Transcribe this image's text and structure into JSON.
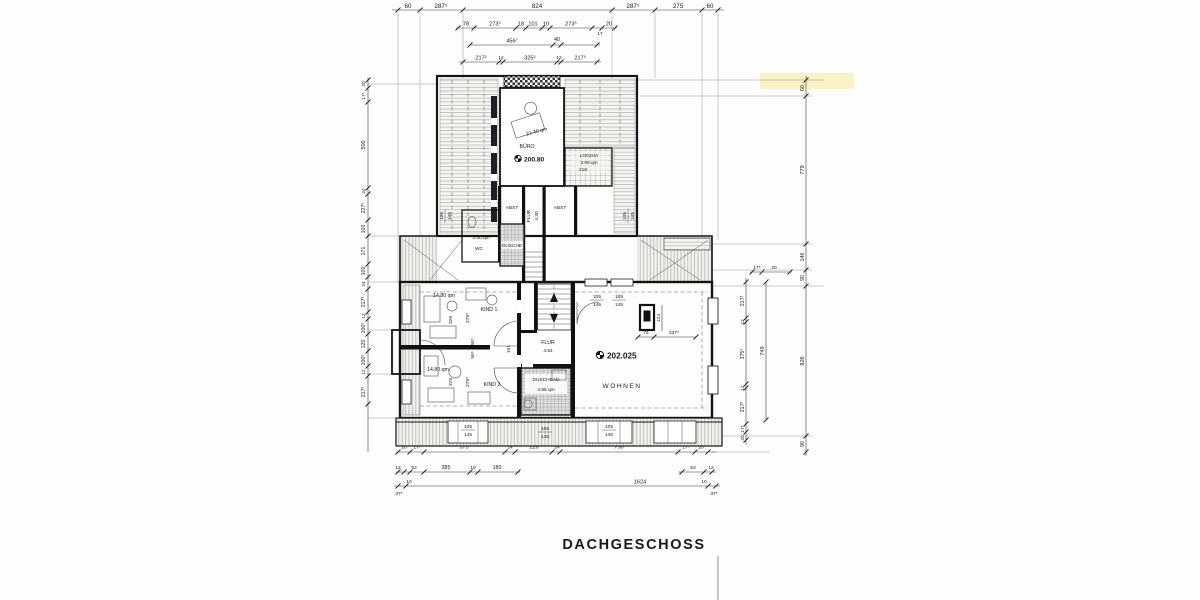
{
  "title": "DACHGESCHOSS",
  "levels": {
    "upper": "200.80",
    "lower": "202.025"
  },
  "rooms": {
    "buero": {
      "label": "BÜRO",
      "area": "21.40 qm"
    },
    "loggia": {
      "label": "LOGGIA",
      "area": "3.69 qm",
      "width": "218"
    },
    "abst_left": {
      "label": "ABST"
    },
    "abst_right": {
      "label": "ABST"
    },
    "flur_upper": {
      "label": "FLUR",
      "area": "4.30"
    },
    "wc": {
      "label": "WC",
      "area": "3.50 qm"
    },
    "dusche": {
      "label": "DUSCHE"
    },
    "kind1": {
      "label": "KIND 1",
      "area": "14.80 qm"
    },
    "kind2": {
      "label": "KIND 2",
      "area": "14.80 qm"
    },
    "flur": {
      "label": "FLUR",
      "area": "4.54"
    },
    "duschbad": {
      "label": "DUSCHBAD",
      "area": "4.85 qm"
    },
    "wohnen": {
      "label": "WOHNEN"
    }
  },
  "dims": {
    "top1": [
      "60",
      "287⁵",
      "824",
      "287⁵",
      "275",
      "60"
    ],
    "top2": [
      "78",
      "273⁵",
      "18",
      "101",
      "10",
      "273⁵",
      "17",
      "20"
    ],
    "top3": [
      "456⁷",
      "40"
    ],
    "top4": [
      "217²",
      "12",
      "325⁵",
      "12",
      "217³"
    ],
    "left": [
      "20",
      "17⁵",
      "500",
      "24",
      "227⁵",
      "100",
      "171",
      "100",
      "24",
      "217³",
      "12",
      "100⁵",
      "120",
      "100⁵",
      "12",
      "217²"
    ],
    "right_outer": [
      "60",
      "779",
      "146",
      "90",
      "826",
      "90"
    ],
    "right_corner": [
      "17⁵",
      "20"
    ],
    "right_inner": [
      "217³",
      "12",
      "375⁵",
      "12",
      "217²",
      "17⁵",
      "20"
    ],
    "right_total": "749",
    "bottom1": [
      "20",
      "17⁵",
      "575",
      "24",
      "226",
      "24",
      "750",
      "17⁵",
      "20"
    ],
    "bottom2_left": [
      "12",
      "53",
      "385",
      "10",
      "180"
    ],
    "bottom2_right": [
      "53",
      "12"
    ],
    "bottom3": [
      "37⁵",
      "10",
      "1624",
      "10",
      "37⁵"
    ],
    "window_pair": {
      "top": "105",
      "bottom": "145"
    },
    "kind1": [
      "329",
      "279⁵"
    ],
    "kind2": [
      "379",
      "279⁵"
    ],
    "flur_doors": [
      "55⁵",
      "55⁶",
      "101"
    ],
    "chimney": [
      "124",
      "74",
      "237⁵"
    ]
  },
  "colors": {
    "highlight": "#f6edb4",
    "ink": "#1a1a1a"
  }
}
